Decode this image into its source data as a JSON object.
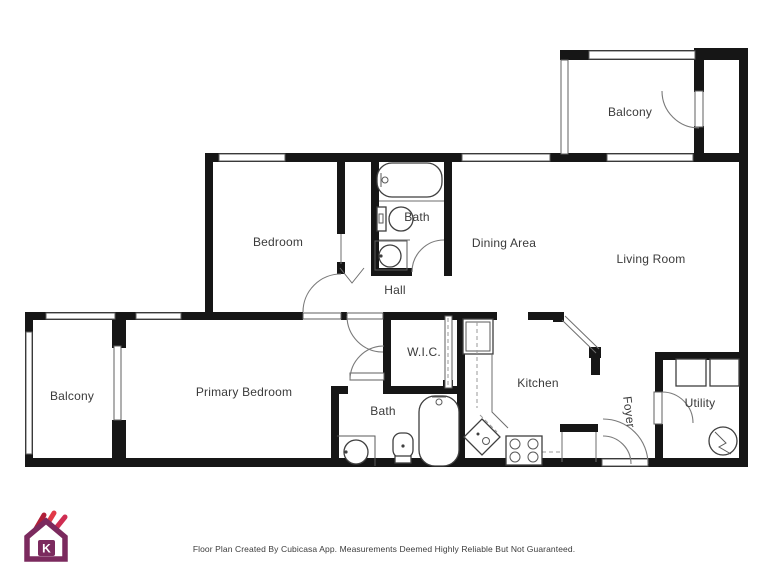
{
  "colors": {
    "wall": "#161616",
    "fixture_line": "#3f3f3f",
    "brand_purple": "#7b2a5e",
    "brand_red_dark": "#b01f38",
    "brand_red": "#e23a47",
    "brand_crimson": "#cf2d52"
  },
  "rooms": {
    "balcony_upper": {
      "label": "Balcony"
    },
    "bedroom": {
      "label": "Bedroom"
    },
    "bath_upper": {
      "label": "Bath"
    },
    "dining_area": {
      "label": "Dining Area"
    },
    "living_room": {
      "label": "Living Room"
    },
    "hall": {
      "label": "Hall"
    },
    "balcony_lower": {
      "label": "Balcony"
    },
    "primary_bedroom": {
      "label": "Primary Bedroom"
    },
    "wic": {
      "label": "W.I.C."
    },
    "bath_lower": {
      "label": "Bath"
    },
    "kitchen": {
      "label": "Kitchen"
    },
    "foyer": {
      "label": "Foyer"
    },
    "utility": {
      "label": "Utility"
    }
  },
  "logo": {
    "letter": "K"
  },
  "footer": {
    "text": "Floor Plan Created By Cubicasa App. Measurements Deemed Highly Reliable But Not Guaranteed."
  }
}
